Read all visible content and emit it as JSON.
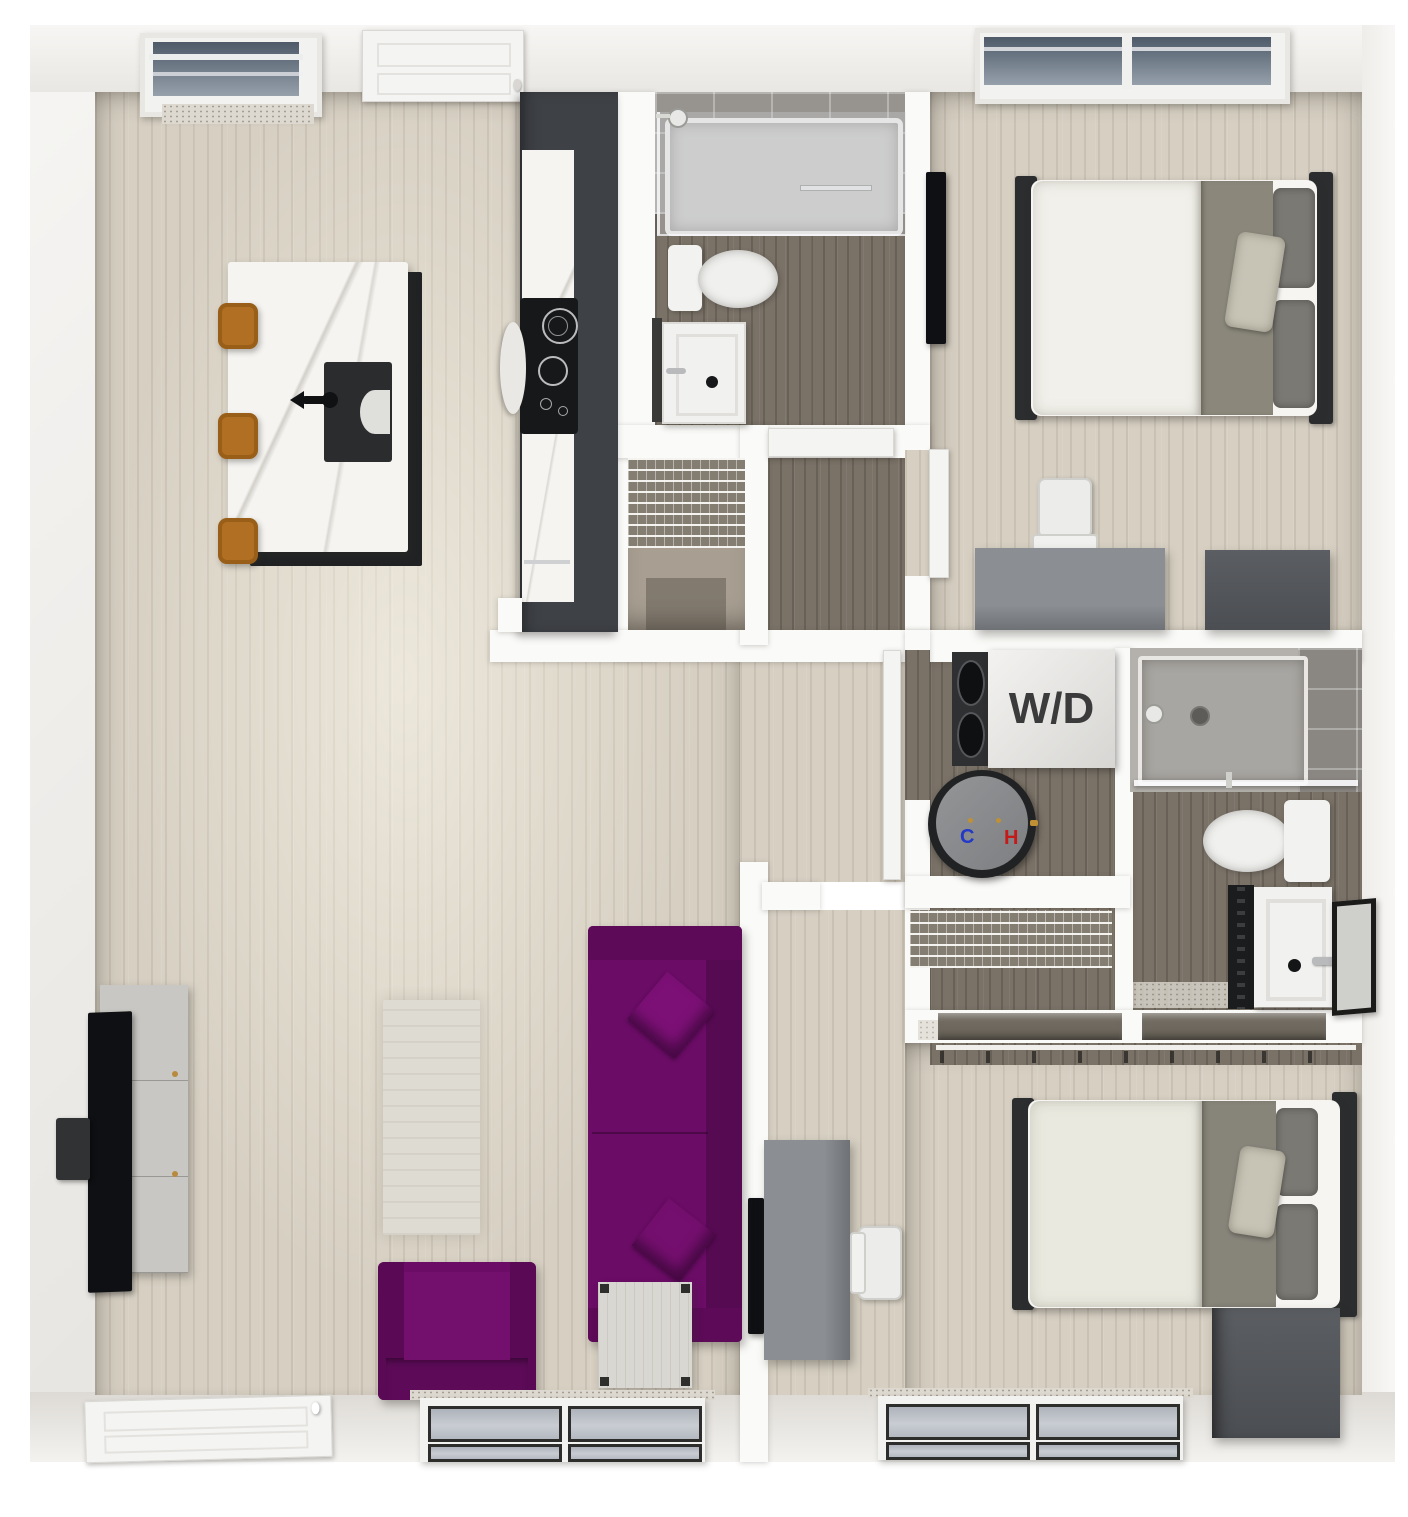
{
  "labels": {
    "washer_dryer": "W/D",
    "cold_valve": "C",
    "hot_valve": "H"
  },
  "colors": {
    "accent_purple": "#6b0c66",
    "accent_purple_dark": "#560a52",
    "stool_amber": "#b06f22",
    "cabinet_charcoal": "#3e4146",
    "floor_light_wood": "#d6cfc2",
    "floor_dark_wood": "#7a7267",
    "wall_white": "#fafaf8",
    "glass_gray": "#b9bcc3",
    "cold_blue": "#2438c8",
    "hot_red": "#c41a1a"
  },
  "rooms": {
    "living_kitchen": [
      "kitchen-island",
      "bar-stools",
      "island-sink",
      "kitchen-cabinet-run",
      "cooktop",
      "sofa",
      "armchair",
      "side-table",
      "rug",
      "tv",
      "media-console",
      "entry-door",
      "window",
      "skylight-window"
    ],
    "bathroom_1": [
      "tub-shower",
      "shower-head",
      "toilet",
      "vanity-sink",
      "mirror",
      "door"
    ],
    "bedroom_1": [
      "bed",
      "pillows",
      "tv",
      "desk",
      "desk-chair",
      "dresser",
      "window",
      "door"
    ],
    "laundry_closet": [
      "washer-dryer",
      "water-heater",
      "door"
    ],
    "pantry_closet": [
      "wire-shelving"
    ],
    "linen_closet": [
      "wire-shelving"
    ],
    "bathroom_2": [
      "shower",
      "shower-head",
      "toilet",
      "vanity-sink",
      "mirror"
    ],
    "bedroom_2": [
      "bed",
      "pillows",
      "tv",
      "desk",
      "desk-chair",
      "dresser",
      "closet-rods",
      "window"
    ]
  }
}
